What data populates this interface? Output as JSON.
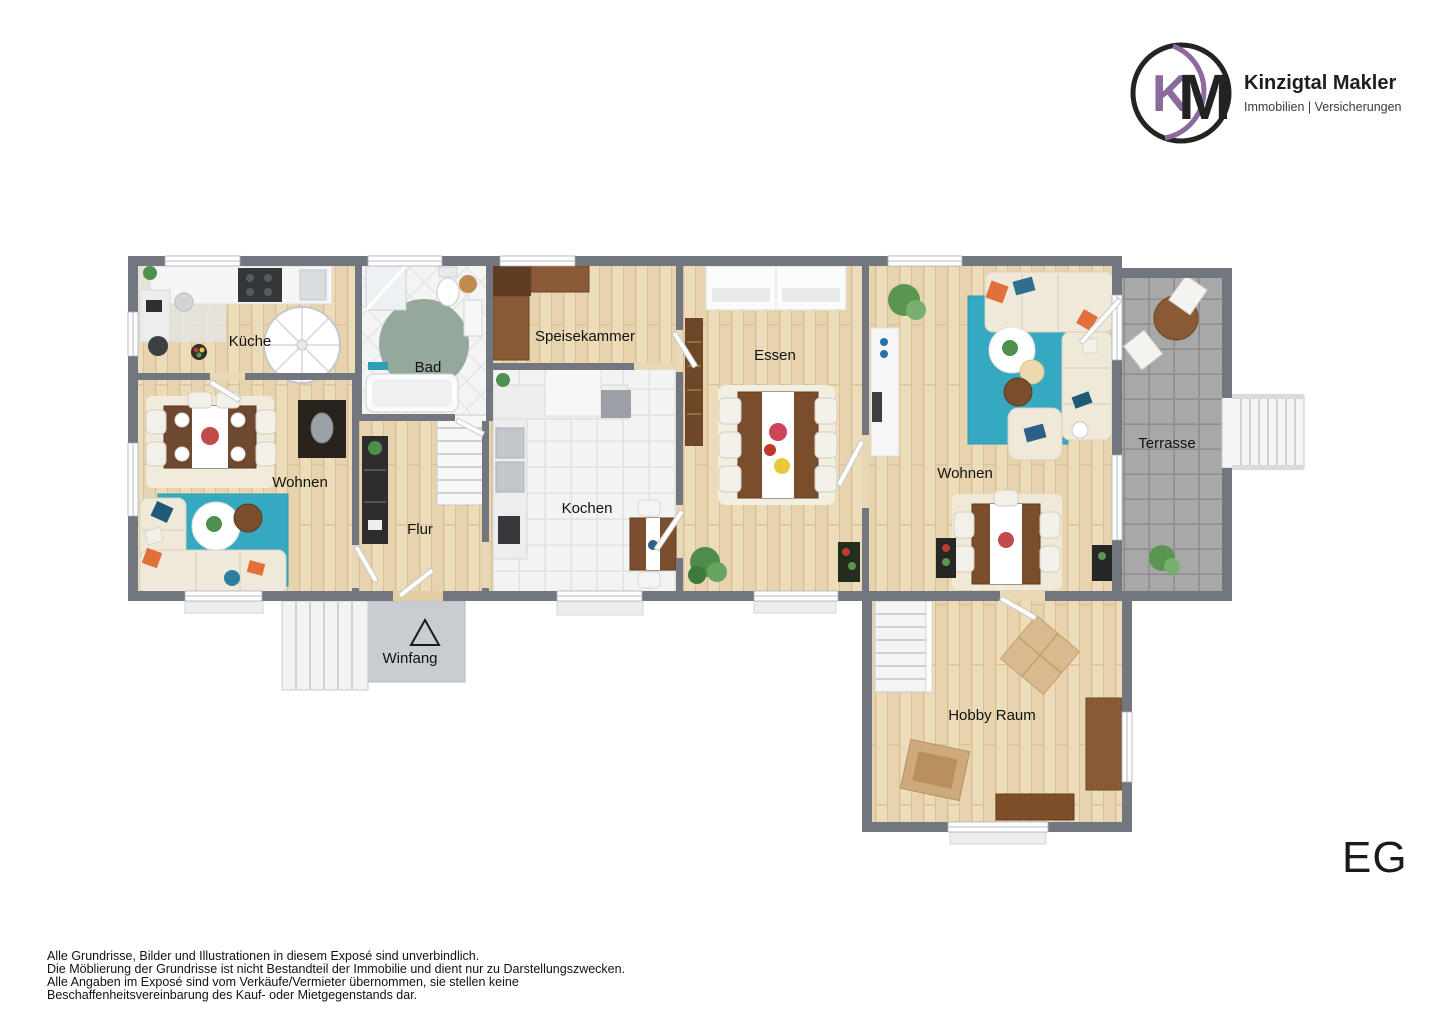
{
  "header": {
    "logo_k": "K",
    "logo_m": "M",
    "company": "Kinzigtal Makler",
    "tagline": "Immobilien | Versicherungen"
  },
  "plan": {
    "rooms": {
      "kueche": "Küche",
      "bad": "Bad",
      "speisekammer": "Speisekammer",
      "essen": "Essen",
      "wohnen_links": "Wohnen",
      "flur": "Flur",
      "kochen": "Kochen",
      "wohnen_rechts": "Wohnen",
      "terrasse": "Terrasse",
      "winfang": "Winfang",
      "hobby_raum": "Hobby Raum"
    },
    "floor_label": "EG"
  },
  "footer": {
    "lines": [
      "Alle Grundrisse, Bilder und Illustrationen in diesem Exposé sind unverbindlich.",
      "Die Möblierung der Grundrisse ist nicht Bestandteil der Immobilie und dient nur zu Darstellungszwecken.",
      "Alle Angaben im Exposé sind vom Verkäufe/Vermieter übernommen, sie stellen keine",
      "Beschaffenheitsvereinbarung des Kauf- oder Mietgegenstands dar."
    ]
  },
  "colors": {
    "accent_purple": "#8a6b9b",
    "wall_gray": "#72777f",
    "wood_floor": "#ebdaba",
    "tile_white": "#f2f2f3",
    "terrace_gray": "#a7a7a7",
    "teal_rug": "#35a8c2",
    "sofa_beige": "#efe9da",
    "furniture_brown": "#7a4e2c",
    "accent_orange": "#e2703a",
    "bath_rug_green": "#94a99c"
  }
}
